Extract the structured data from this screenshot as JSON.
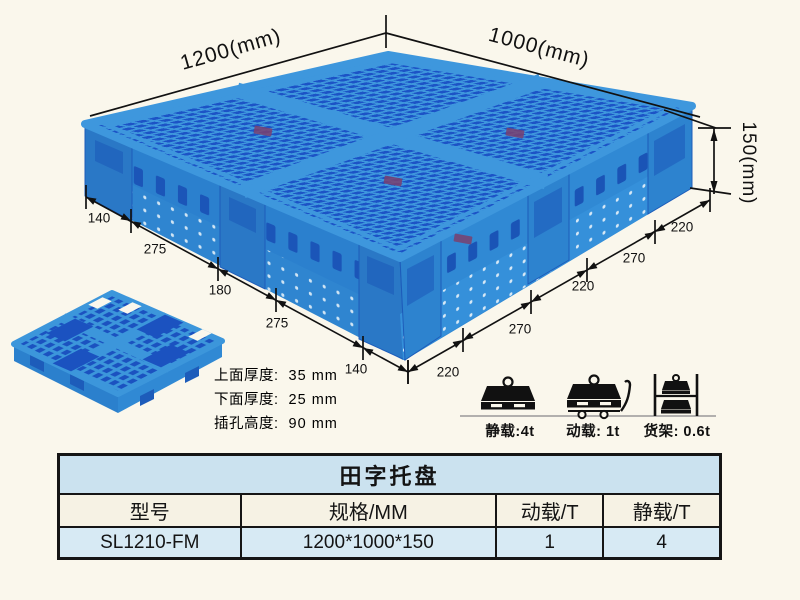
{
  "page": {
    "background": "#faf7ec"
  },
  "illustration": {
    "dims": {
      "length_label": "1200(mm)",
      "width_label": "1000(mm)",
      "height_label": "150(mm)",
      "left_edge_segments": [
        "140",
        "275",
        "180",
        "275",
        "140"
      ],
      "right_edge_segments": [
        "220",
        "270",
        "220",
        "270",
        "220"
      ]
    },
    "colors": {
      "pallet_light": "#3e97dd",
      "pallet_dark": "#1c53c6",
      "pallet_wall": "#2b80ce",
      "accent_table_title": "#cbe2ef",
      "accent_table_row": "#d7eaf4"
    }
  },
  "specs": {
    "items": [
      {
        "label": "上面厚度:",
        "value": "35 mm"
      },
      {
        "label": "下面厚度:",
        "value": "25 mm"
      },
      {
        "label": "插孔高度:",
        "value": "90 mm"
      }
    ]
  },
  "loads": {
    "items": [
      {
        "name": "static-load",
        "label": "静载:4t"
      },
      {
        "name": "dynamic-load",
        "label": "动载: 1t"
      },
      {
        "name": "rack-load",
        "label": "货架: 0.6t"
      }
    ]
  },
  "table": {
    "title": "田字托盘",
    "headers": [
      "型号",
      "规格/MM",
      "动载/T",
      "静载/T"
    ],
    "rows": [
      [
        "SL1210-FM",
        "1200*1000*150",
        "1",
        "4"
      ]
    ]
  }
}
